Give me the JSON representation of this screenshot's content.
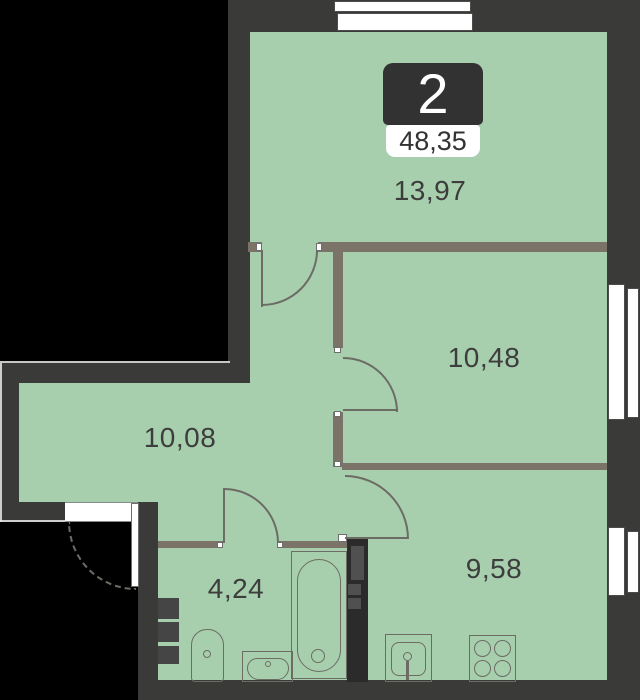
{
  "title": "2-room apartment floor plan",
  "badge": {
    "rooms": "2",
    "total_area": "48,35"
  },
  "rooms": [
    {
      "name": "living-room",
      "area": "13,97"
    },
    {
      "name": "bedroom",
      "area": "10,48"
    },
    {
      "name": "hallway",
      "area": "10,08"
    },
    {
      "name": "kitchen",
      "area": "9,58"
    },
    {
      "name": "bathroom",
      "area": "4,24"
    }
  ],
  "colors": {
    "background": "#000000",
    "outer_wall": "#3a3a38",
    "inner_wall": "#7b7268",
    "floor": "#a7cfad",
    "shaft_wall": "#2b2b2b",
    "shaft_block": "#505050",
    "line": "#6c6c65",
    "badge_dark": "#323232",
    "label_text": "#3d3d3d",
    "window_border": "#4c4c4c",
    "edge_light": "#e9e9e9"
  }
}
